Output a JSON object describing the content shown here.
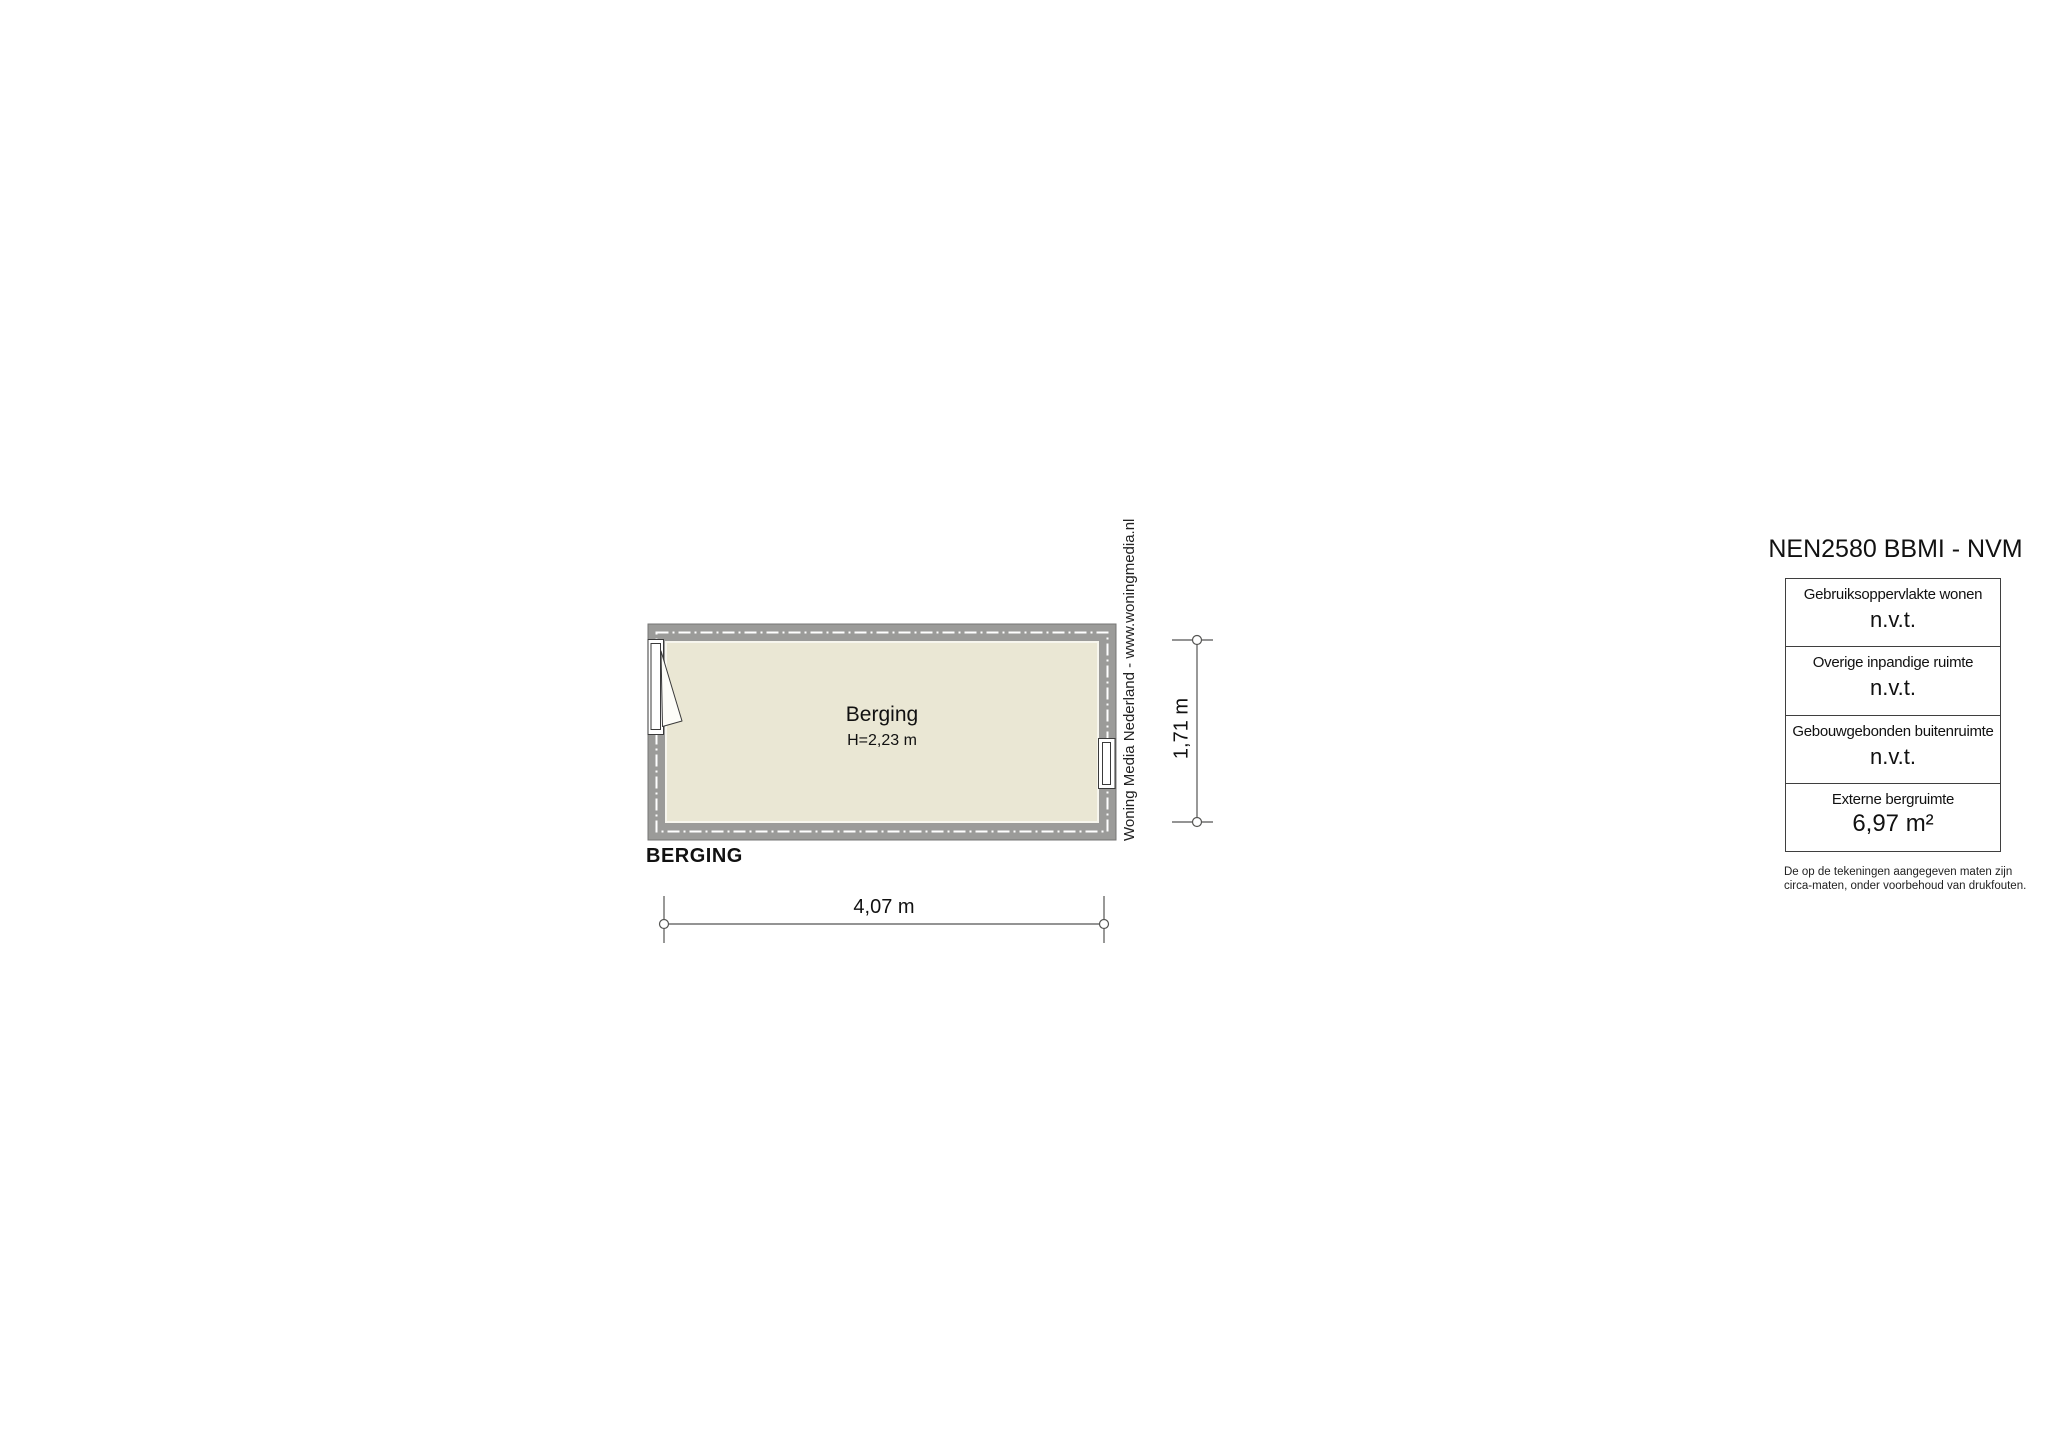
{
  "plan": {
    "room_name": "Berging",
    "room_height": "H=2,23 m",
    "plan_title": "BERGING",
    "dim_width": "4,07 m",
    "dim_height": "1,71 m"
  },
  "branding": {
    "text": "Woning Media Nederland - www.woningmedia.nl"
  },
  "legend": {
    "title": "NEN2580 BBMI - NVM",
    "rows": [
      {
        "label": "Gebruiksoppervlakte wonen",
        "value": "n.v.t."
      },
      {
        "label": "Overige inpandige ruimte",
        "value": "n.v.t."
      },
      {
        "label": "Gebouwgebonden buitenruimte",
        "value": "n.v.t."
      },
      {
        "label": "Externe bergruimte",
        "value": "6,97 m²"
      }
    ],
    "disclaimer_line1": "De op de tekeningen aangegeven maten zijn",
    "disclaimer_line2": "circa-maten, onder voorbehoud van drukfouten."
  },
  "colors": {
    "wall": "#9b9b99",
    "floor": "#eae7d4",
    "line": "#3a3a3a",
    "dash": "#ffffff"
  }
}
